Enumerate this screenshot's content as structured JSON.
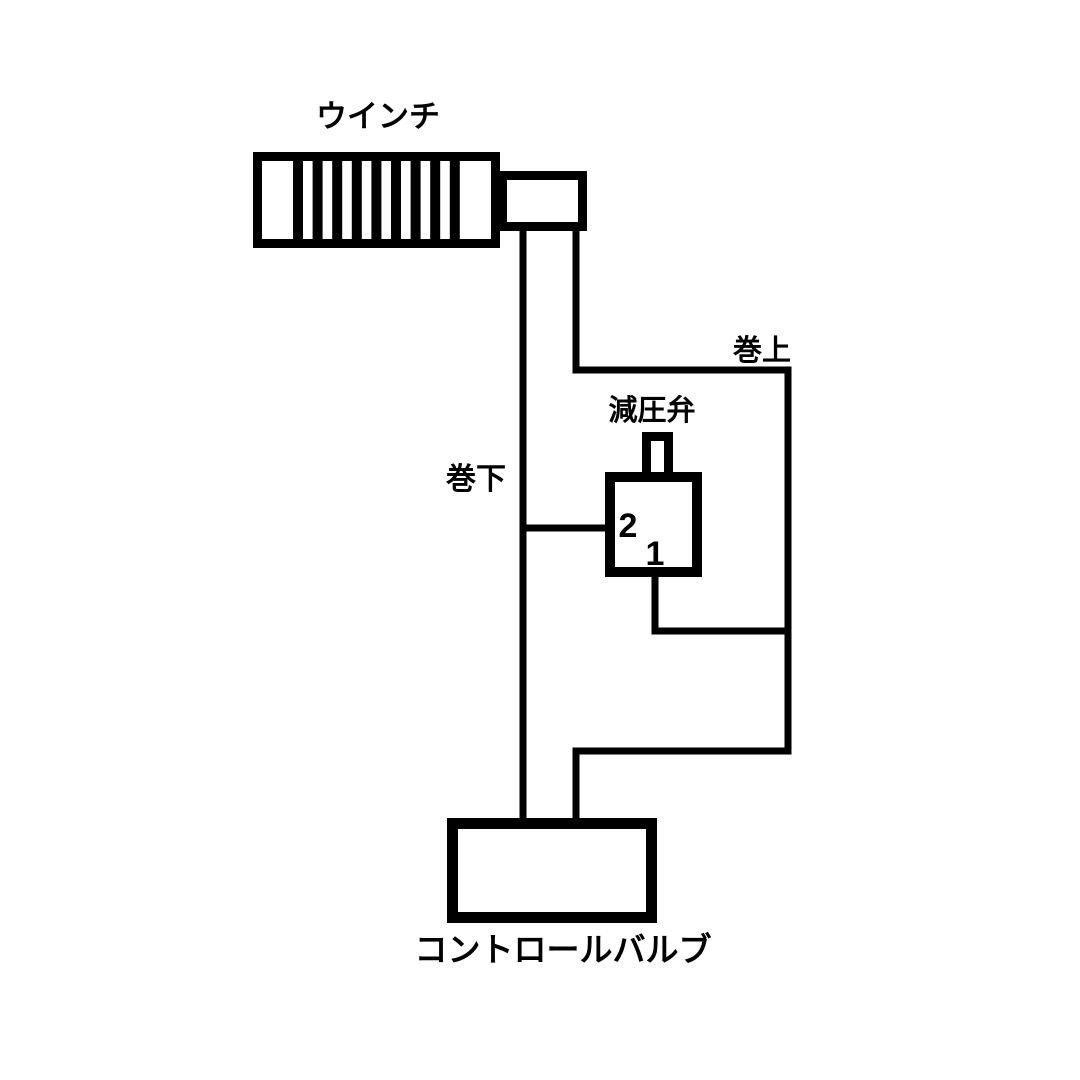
{
  "diagram": {
    "type": "hydraulic-circuit-diagram",
    "colors": {
      "line": "#000000",
      "background": "#ffffff"
    },
    "labels": {
      "winch": "ウインチ",
      "hoist_up": "巻上",
      "hoist_down": "巻下",
      "pressure_reducing_valve": "減圧弁",
      "control_valve": "コントロールバルブ"
    },
    "reducing_valve_ports": {
      "port_2": "2",
      "port_1": "1"
    }
  }
}
